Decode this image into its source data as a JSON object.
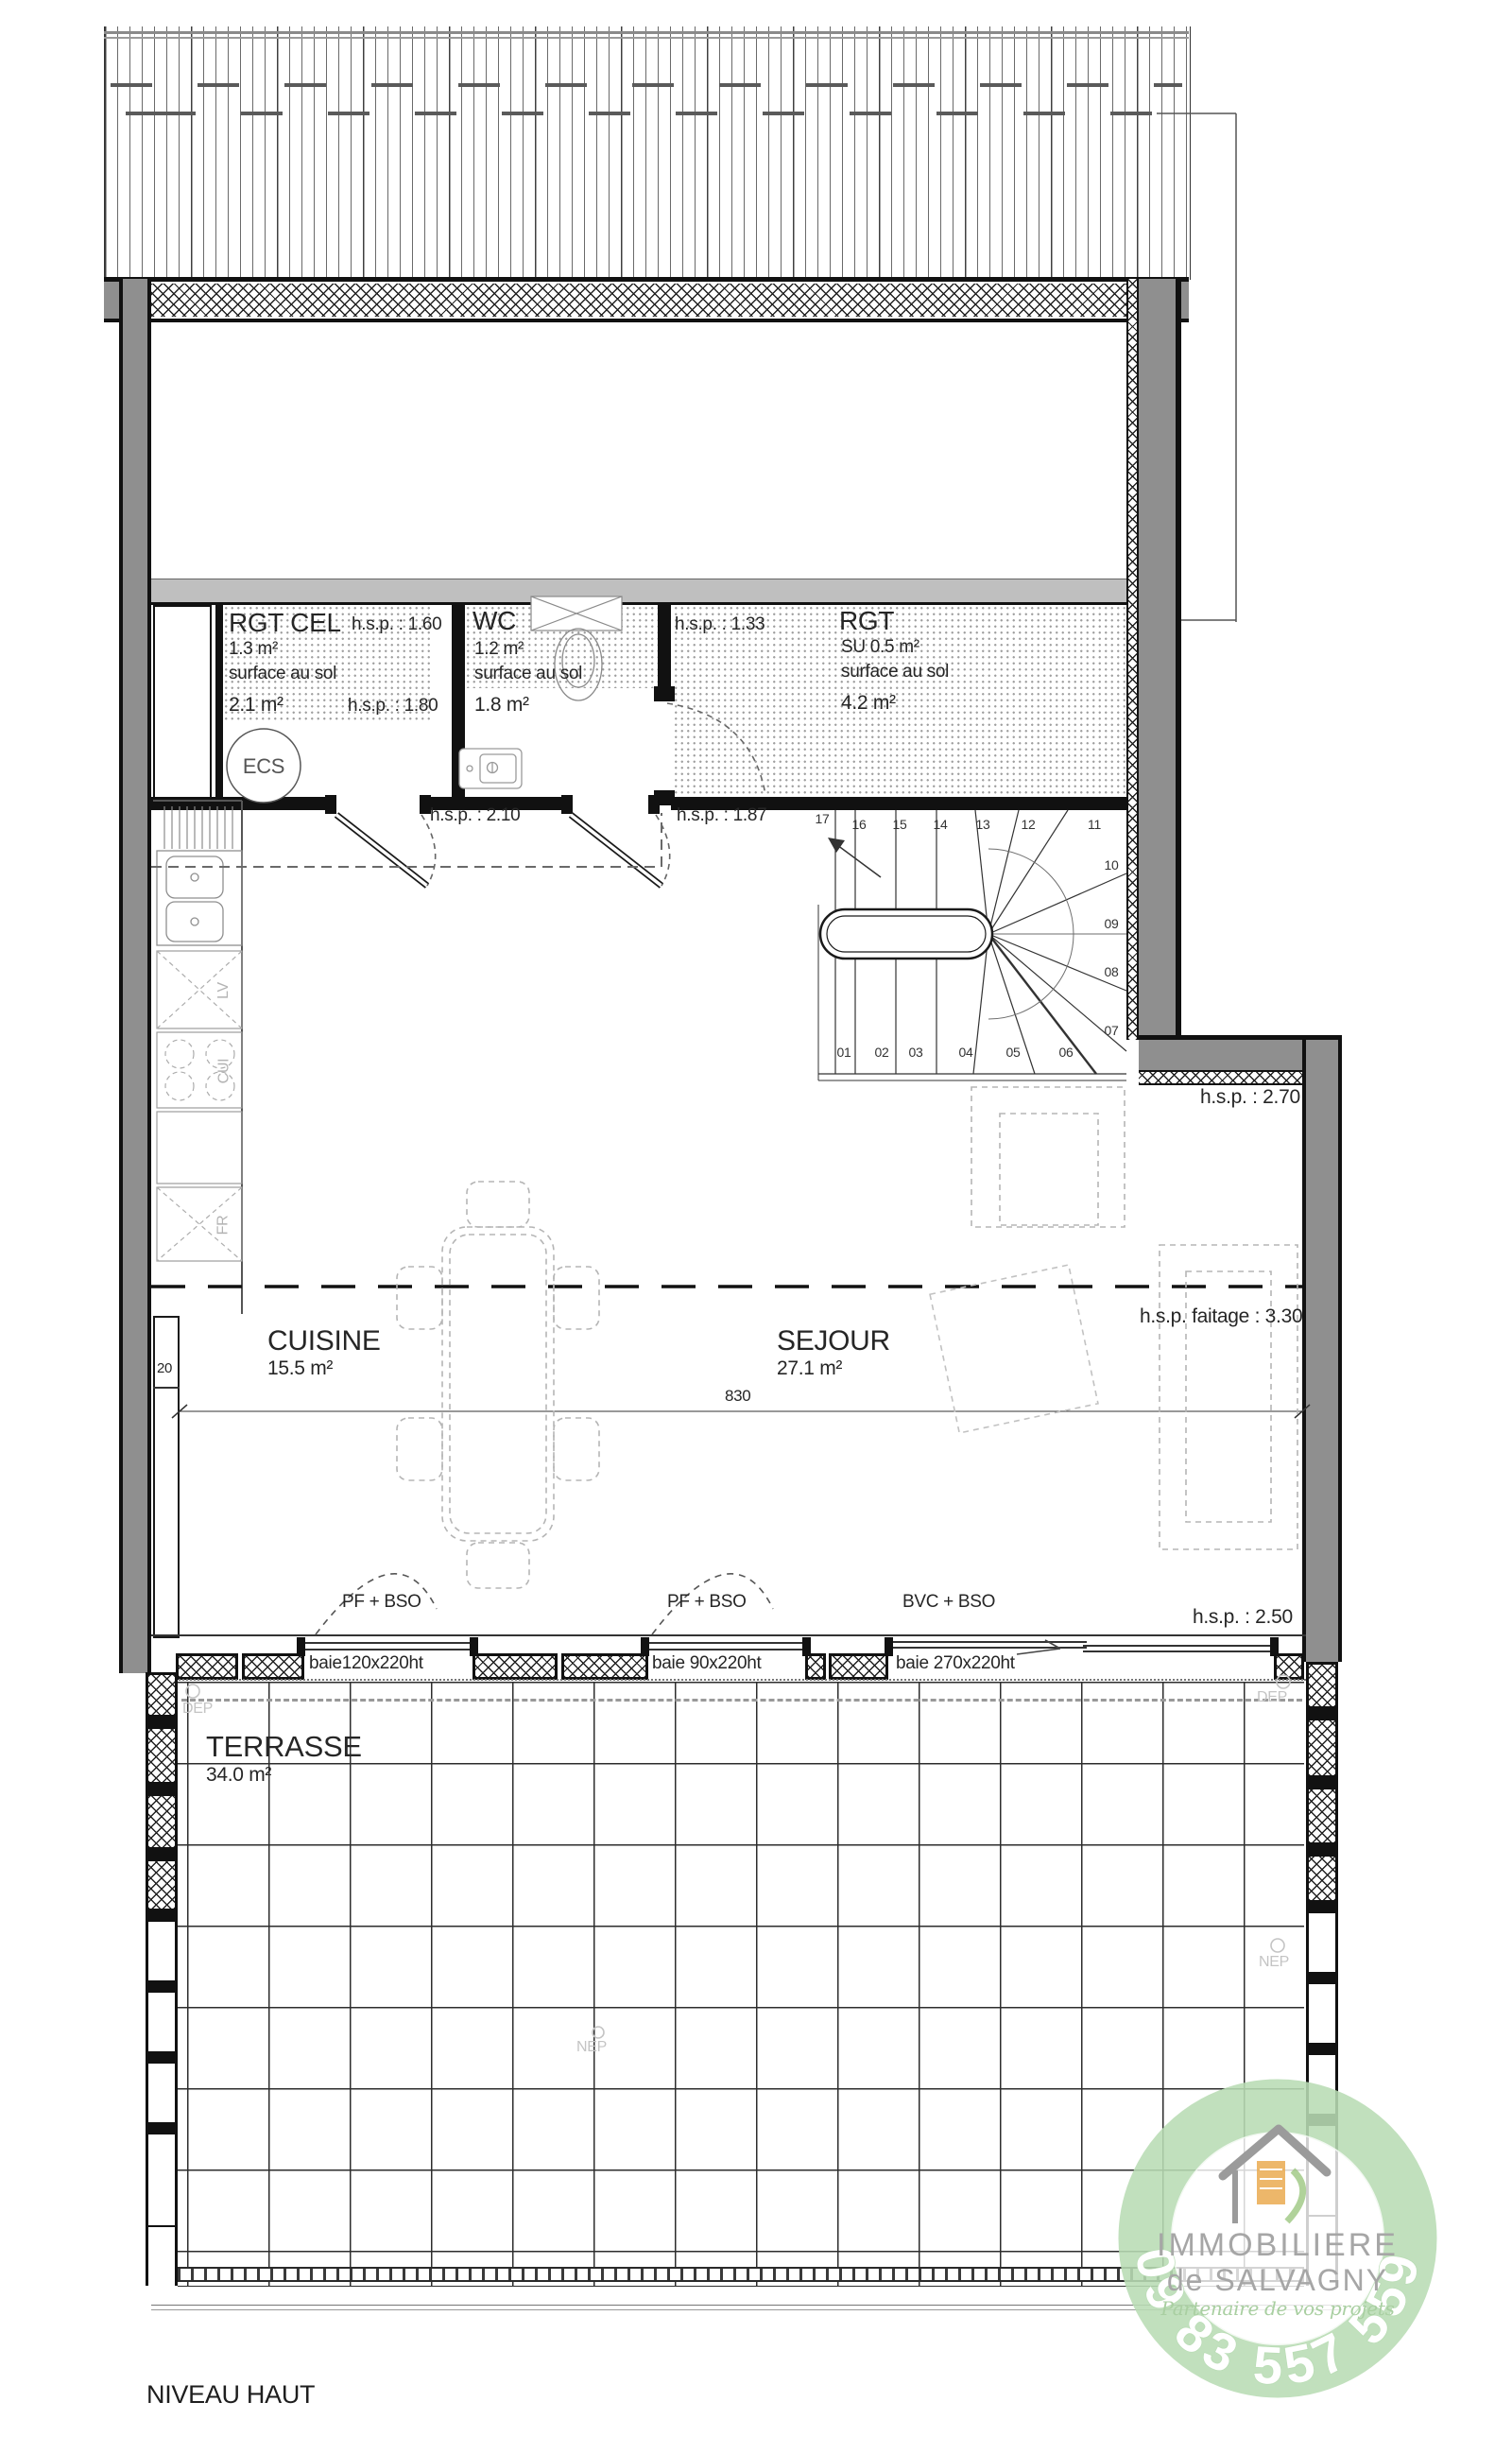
{
  "meta": {
    "level_label": "NIVEAU HAUT"
  },
  "colors": {
    "wall_gray": "#8f8f8f",
    "room_band_gray": "#bfbfbf",
    "logo_ring_green": "#b8dcb4",
    "logo_text_gray": "#a6a6a6",
    "logo_script_green": "#a9cfa1",
    "logo_orange": "#eaaa50",
    "faint_label_gray": "#c4c4c4"
  },
  "rooms": {
    "rgt_cel": {
      "name": "RGT CEL",
      "su": "1.3 m²",
      "note": "surface au sol",
      "floor": "2.1 m²",
      "hsp_top": "h.s.p. : 1.60",
      "hsp_bottom": "h.s.p. : 1.80",
      "equipment": "ECS"
    },
    "wc": {
      "name": "WC",
      "su": "1.2 m²",
      "note": "surface au sol",
      "floor": "1.8 m²"
    },
    "rgt": {
      "name": "RGT",
      "su": "SU 0.5 m²",
      "note": "surface au sol",
      "floor": "4.2 m²",
      "hsp": "h.s.p. : 1.33"
    },
    "cuisine": {
      "name": "CUISINE",
      "area": "15.5 m²"
    },
    "sejour": {
      "name": "SEJOUR",
      "area": "27.1 m²"
    },
    "terrasse": {
      "name": "TERRASSE",
      "area": "34.0 m²"
    }
  },
  "annotations": {
    "hsp_210": "h.s.p. : 2.10",
    "hsp_187": "h.s.p. : 1.87",
    "hsp_270": "h.s.p. : 2.70",
    "hsp_faitage": "h.s.p. faitage : 3.30",
    "hsp_250": "h.s.p. : 2.50",
    "dim_830": "830",
    "dim_20": "20",
    "dep": "DEP",
    "nep": "NEP"
  },
  "kitchen": {
    "dishwasher": "LV",
    "cooktop": "CUI",
    "fridge": "FR"
  },
  "windows": {
    "pf_bso": "PF + BSO",
    "bvc_bso": "BVC + BSO",
    "baie_120": "baie120x220ht",
    "baie_90": "baie 90x220ht",
    "baie_270": "baie 270x220ht"
  },
  "stairs": {
    "numbers": [
      "01",
      "02",
      "03",
      "04",
      "05",
      "06",
      "07",
      "08",
      "09",
      "10",
      "11",
      "12",
      "13",
      "14",
      "15",
      "16",
      "17"
    ]
  },
  "logo": {
    "line1": "IMMOBILIERE",
    "line2": "de SALVAGNY",
    "tagline": "Partenaire de vos projets",
    "phone": "09 83 557 559",
    "house_accent": "2"
  }
}
